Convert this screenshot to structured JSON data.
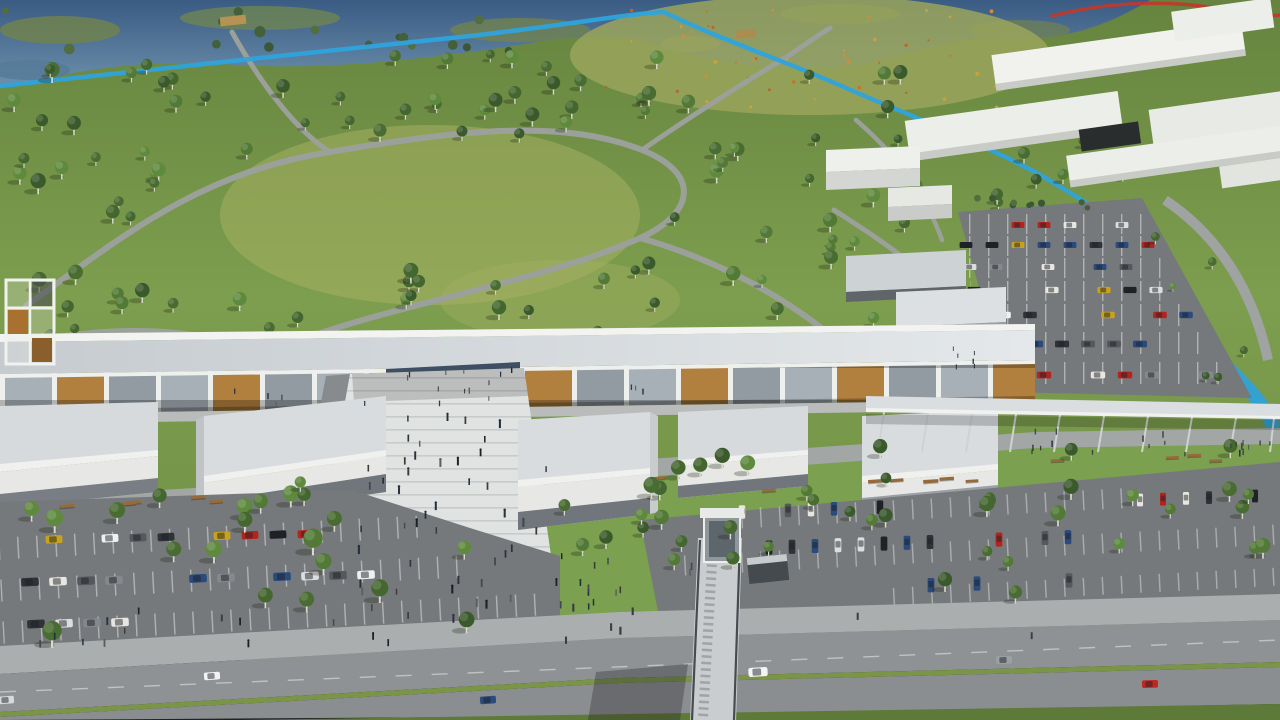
{
  "meta": {
    "description": "Aerial 3D architectural rendering: a long linear white shopping/cultural gallery building with flat-roof pavilions and a stepped pedestrian plaza, fronted by tree-lined parking lots and a highway with a pedestrian footbridge; behind it a large public park with scattered trees, winding paths, a wetland with a stream, a blue bike path, a wildflower meadow, and a white massing-block building complex with its own parking lot at top right."
  },
  "colors": {
    "grass_dark": "#66843f",
    "grass": "#7d9e4e",
    "lawn": "#7ba04f",
    "meadow": "#9aa55c",
    "water": "#4a6d92",
    "marsh": "#70824f",
    "bike_path": "#2fa3dc",
    "track_red": "#c0392b",
    "path_gray": "#9ba19a",
    "building_white": "#eceee9",
    "building_shade": "#c9ccc6",
    "roof_light": "#d8dcdf",
    "roof_fascia": "#f0f1ef",
    "wood_accent": "#b2803e",
    "glass_gray": "#a7b0b7",
    "colonnade_dark": "#565c63",
    "entrance_glass": "#3e4f63",
    "grille_dark": "#70767c",
    "plaza_paving": "#e1e3e2",
    "plaza_edge": "#878b8d",
    "walk_gray": "#a2a6a5",
    "promenade": "#abaeaf",
    "asphalt": "#76797c",
    "road": "#8f9294",
    "median_green": "#7a9448",
    "verge_green": "#5d7a39",
    "canopy": "#dadee1",
    "bridge_deck": "#c9cdcf",
    "bridge_rail": "#464b50",
    "bench_wood": "#996a39",
    "tree_trunk": "#d9dbcc"
  },
  "scene": {
    "palettes": {
      "tree": [
        "#3b5a2c",
        "#44662f",
        "#527a36",
        "#5f8a3e",
        "#486c31"
      ],
      "bush": [
        "#44603a",
        "#3c5735",
        "#526e40"
      ],
      "flower": [
        "#c4762f",
        "#d28c3a",
        "#b9672a",
        "#caa23c"
      ],
      "person": [
        "#1d2126",
        "#2c3340",
        "#3c3a36",
        "#21303f",
        "#44484e",
        "#5a5e63"
      ],
      "car": [
        "#f0f0f0",
        "#dcdddf",
        "#2f3236",
        "#55585c",
        "#b3241f",
        "#c8a21f",
        "#2a4b7c",
        "#85898d",
        "#1f2327",
        "#e8e6e0"
      ],
      "dark": [
        "#3a3e42"
      ]
    },
    "scatters": [
      {
        "name": "park-tree",
        "symbol": "tree",
        "layer": "trees-park",
        "palette": "tree",
        "x": [
          8,
          258
        ],
        "y": [
          64,
          346
        ],
        "count": 34,
        "scale": [
          0.75,
          1.25
        ],
        "seed": 7
      },
      {
        "name": "park-tree",
        "symbol": "tree",
        "layer": "trees-park",
        "palette": "tree",
        "x": [
          258,
          660
        ],
        "y": [
          56,
          148
        ],
        "count": 26,
        "scale": [
          0.7,
          1.15
        ],
        "seed": 11
      },
      {
        "name": "park-tree",
        "symbol": "tree",
        "layer": "trees-park",
        "palette": "tree",
        "x": [
          620,
          908
        ],
        "y": [
          78,
          338
        ],
        "count": 30,
        "scale": [
          0.7,
          1.2
        ],
        "seed": 13
      },
      {
        "name": "park-tree",
        "symbol": "tree",
        "layer": "trees-park",
        "palette": "tree",
        "x": [
          258,
          640
        ],
        "y": [
          276,
          342
        ],
        "count": 12,
        "scale": [
          0.8,
          1.2
        ],
        "seed": 17
      },
      {
        "name": "park-tree",
        "symbol": "tree",
        "layer": "trees-park",
        "palette": "tree",
        "x": [
          898,
          1130
        ],
        "y": [
          120,
          218
        ],
        "count": 15,
        "scale": [
          0.6,
          1.0
        ],
        "seed": 19
      },
      {
        "name": "wetland-bush",
        "symbol": "bush",
        "layer": "ground-decor",
        "palette": "bush",
        "x": [
          0,
          540
        ],
        "y": [
          6,
          52
        ],
        "count": 16,
        "scale": [
          0.8,
          1.6
        ],
        "seed": 23
      },
      {
        "name": "meadow-flower",
        "symbol": "dot",
        "layer": "ground-decor",
        "palette": "flower",
        "x": [
          600,
          1010
        ],
        "y": [
          10,
          112
        ],
        "count": 46,
        "scale": [
          0.6,
          1.3
        ],
        "seed": 29
      },
      {
        "name": "hedge-bush",
        "symbol": "bush",
        "layer": "trees-ne",
        "palette": "bush",
        "x": [
          972,
          1105
        ],
        "y": [
          198,
          208
        ],
        "count": 9,
        "scale": [
          0.7,
          1.0
        ],
        "seed": 31
      },
      {
        "name": "parking-island-tree",
        "symbol": "tree",
        "layer": "trees-ne",
        "palette": "tree",
        "x": [
          1150,
          1268
        ],
        "y": [
          215,
          390
        ],
        "count": 6,
        "scale": [
          0.5,
          0.75
        ],
        "seed": 33
      },
      {
        "name": "lawn-tree",
        "symbol": "tree",
        "layer": "trees-fg",
        "palette": "tree",
        "x": [
          25,
          345
        ],
        "y": [
          480,
          535
        ],
        "count": 9,
        "scale": [
          0.85,
          1.3
        ],
        "seed": 37
      },
      {
        "name": "lawn-tree",
        "symbol": "tree",
        "layer": "trees-fg",
        "palette": "tree",
        "x": [
          560,
          695
        ],
        "y": [
          468,
          568
        ],
        "count": 11,
        "scale": [
          0.9,
          1.4
        ],
        "seed": 41
      },
      {
        "name": "lawn-tree",
        "symbol": "tree",
        "layer": "trees-fg",
        "palette": "tree",
        "x": [
          700,
          1272
        ],
        "y": [
          450,
          522
        ],
        "count": 20,
        "scale": [
          0.8,
          1.3
        ],
        "seed": 43
      },
      {
        "name": "parking-tree",
        "symbol": "tree",
        "layer": "trees-fg",
        "palette": "tree",
        "x": [
          8,
          525
        ],
        "y": [
          498,
          642
        ],
        "count": 12,
        "scale": [
          1.0,
          1.6
        ],
        "seed": 47
      },
      {
        "name": "parking-tree",
        "symbol": "tree",
        "layer": "trees-fg",
        "palette": "tree",
        "x": [
          700,
          1272
        ],
        "y": [
          522,
          600
        ],
        "count": 12,
        "scale": [
          0.8,
          1.25
        ],
        "seed": 53
      },
      {
        "name": "plaza-person",
        "symbol": "person",
        "layer": "people",
        "palette": "person",
        "x": [
          356,
          550
        ],
        "y": [
          418,
          630
        ],
        "count": 46,
        "scale": [
          0.8,
          1.25
        ],
        "seed": 59
      },
      {
        "name": "colonnade-person",
        "symbol": "person",
        "layer": "people",
        "palette": "person",
        "x": [
          180,
          660
        ],
        "y": [
          384,
          408
        ],
        "count": 12,
        "scale": [
          0.6,
          0.85
        ],
        "seed": 61
      },
      {
        "name": "promenade-person",
        "symbol": "person",
        "layer": "people",
        "palette": "person",
        "x": [
          20,
          420
        ],
        "y": [
          614,
          650
        ],
        "count": 12,
        "scale": [
          0.8,
          1.1
        ],
        "seed": 67
      },
      {
        "name": "bridge-person",
        "symbol": "person",
        "layer": "people",
        "palette": "person",
        "x": [
          556,
          692
        ],
        "y": [
          556,
          610
        ],
        "count": 14,
        "scale": [
          0.8,
          1.1
        ],
        "seed": 71
      },
      {
        "name": "canopy-walk-person",
        "symbol": "person",
        "layer": "people",
        "palette": "person",
        "x": [
          1000,
          1270
        ],
        "y": [
          432,
          458
        ],
        "count": 11,
        "scale": [
          0.7,
          0.95
        ],
        "seed": 73
      },
      {
        "name": "entrance-person",
        "symbol": "person",
        "layer": "people",
        "palette": "person",
        "x": [
          395,
          515
        ],
        "y": [
          372,
          398
        ],
        "count": 8,
        "scale": [
          0.6,
          0.8
        ],
        "seed": 79
      },
      {
        "name": "terrace-person",
        "symbol": "person",
        "layer": "people",
        "palette": "person",
        "x": [
          952,
          1000
        ],
        "y": [
          348,
          386
        ],
        "count": 6,
        "scale": [
          0.55,
          0.7
        ],
        "seed": 81
      },
      {
        "name": "bench",
        "symbol": "bench",
        "layer": "furniture",
        "x": [
          55,
          330
        ],
        "y": [
          496,
          512
        ],
        "count": 5,
        "scale": [
          0.9,
          1.1
        ],
        "rotate": -4,
        "seed": 83
      },
      {
        "name": "bench",
        "symbol": "bench",
        "layer": "furniture",
        "x": [
          570,
          1000
        ],
        "y": [
          478,
          500
        ],
        "count": 7,
        "scale": [
          0.9,
          1.1
        ],
        "rotate": -4,
        "seed": 89
      },
      {
        "name": "bench",
        "symbol": "bench",
        "layer": "furniture",
        "x": [
          1040,
          1262
        ],
        "y": [
          448,
          464
        ],
        "count": 4,
        "scale": [
          0.9,
          1.0
        ],
        "rotate": -2,
        "seed": 97
      },
      {
        "name": "bollard",
        "symbol": "post",
        "layer": "people",
        "palette": "dark",
        "x": [
          1000,
          1270
        ],
        "y": [
          444,
          460
        ],
        "count": 10,
        "scale": [
          0.8,
          1.0
        ],
        "seed": 98
      },
      {
        "name": "light-pole",
        "symbol": "post",
        "layer": "people",
        "palette": "dark",
        "x": [
          30,
          1240
        ],
        "y": [
          600,
          646
        ],
        "count": 8,
        "scale": [
          1.3,
          1.6
        ],
        "seed": 99
      }
    ],
    "car_rows": [
      {
        "name": "parked-car",
        "layer": "cars-ne",
        "x": 966,
        "y": 225,
        "dx": 26,
        "dy": 0,
        "n": 7,
        "gap": 0.25,
        "rotate": 0,
        "scale": 0.8,
        "seed": 101
      },
      {
        "name": "parked-car",
        "layer": "cars-ne",
        "x": 966,
        "y": 245,
        "dx": 26,
        "dy": 0,
        "n": 8,
        "gap": 0.25,
        "rotate": 0,
        "scale": 0.8,
        "seed": 103
      },
      {
        "name": "parked-car",
        "layer": "cars-ne",
        "x": 970,
        "y": 267,
        "dx": 26,
        "dy": 0,
        "n": 8,
        "gap": 0.28,
        "rotate": 0,
        "scale": 0.8,
        "seed": 107
      },
      {
        "name": "parked-car",
        "layer": "cars-ne",
        "x": 974,
        "y": 290,
        "dx": 26,
        "dy": 0,
        "n": 8,
        "gap": 0.28,
        "rotate": 0,
        "scale": 0.82,
        "seed": 109
      },
      {
        "name": "parked-car",
        "layer": "cars-ne",
        "x": 978,
        "y": 315,
        "dx": 26,
        "dy": 0,
        "n": 9,
        "gap": 0.3,
        "rotate": 0,
        "scale": 0.85,
        "seed": 113
      },
      {
        "name": "parked-car",
        "layer": "cars-ne",
        "x": 984,
        "y": 344,
        "dx": 26,
        "dy": 0,
        "n": 9,
        "gap": 0.3,
        "rotate": 0,
        "scale": 0.88,
        "seed": 115
      },
      {
        "name": "parked-car",
        "layer": "cars-ne",
        "x": 990,
        "y": 375,
        "dx": 27,
        "dy": 0,
        "n": 9,
        "gap": 0.3,
        "rotate": 0,
        "scale": 0.9,
        "seed": 117
      },
      {
        "name": "parked-car",
        "layer": "cars-left",
        "x": 26,
        "y": 540,
        "dx": 28,
        "dy": -0.6,
        "n": 11,
        "gap": 0.32,
        "rotate": -3,
        "scale": 1.05,
        "seed": 127
      },
      {
        "name": "parked-car",
        "layer": "cars-left",
        "x": 30,
        "y": 582,
        "dx": 28,
        "dy": -0.6,
        "n": 13,
        "gap": 0.3,
        "rotate": -3,
        "scale": 1.1,
        "seed": 131
      },
      {
        "name": "parked-car",
        "layer": "cars-left",
        "x": 36,
        "y": 624,
        "dx": 28,
        "dy": -0.6,
        "n": 7,
        "gap": 0.45,
        "rotate": -3,
        "scale": 1.1,
        "seed": 137
      },
      {
        "name": "parked-car",
        "layer": "cars-br",
        "x": 742,
        "y": 512,
        "dx": 23,
        "dy": -0.8,
        "n": 7,
        "gap": 0.3,
        "rotate": 90,
        "scale": 0.85,
        "seed": 139
      },
      {
        "name": "parked-car",
        "layer": "cars-br",
        "x": 700,
        "y": 550,
        "dx": 23,
        "dy": -0.8,
        "n": 17,
        "gap": 0.3,
        "rotate": 90,
        "scale": 0.88,
        "seed": 149
      },
      {
        "name": "parked-car",
        "layer": "cars-br",
        "x": 908,
        "y": 586,
        "dx": 23,
        "dy": -0.8,
        "n": 13,
        "gap": 0.3,
        "rotate": 90,
        "scale": 0.9,
        "seed": 151
      },
      {
        "name": "parked-car",
        "layer": "cars-br",
        "x": 1140,
        "y": 500,
        "dx": 23,
        "dy": -0.8,
        "n": 6,
        "gap": 0.35,
        "rotate": 90,
        "scale": 0.8,
        "seed": 157
      }
    ],
    "road_cars": [
      {
        "x": 212,
        "y": 676,
        "rotate": -4,
        "scale": 1.0,
        "color": "#f2f2f2"
      },
      {
        "x": 6,
        "y": 700,
        "rotate": -4,
        "scale": 1.0,
        "color": "#d8d9da"
      },
      {
        "x": 488,
        "y": 700,
        "rotate": -4,
        "scale": 1.0,
        "color": "#2d4b7d"
      },
      {
        "x": 758,
        "y": 672,
        "rotate": -3,
        "scale": 1.2,
        "color": "#f4f4f4"
      },
      {
        "x": 1004,
        "y": 660,
        "rotate": -2,
        "scale": 1.0,
        "color": "#9aa0a4"
      },
      {
        "x": 1150,
        "y": 684,
        "rotate": -2,
        "scale": 1.0,
        "color": "#c0281f"
      }
    ]
  }
}
